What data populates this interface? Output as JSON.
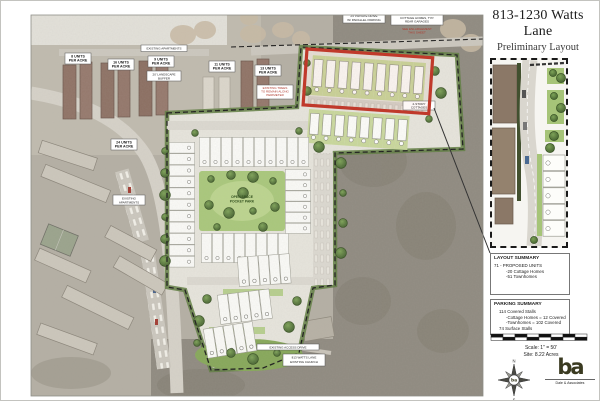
{
  "sheet": {
    "title": "813-1230 Watts Lane",
    "subtitle": "Preliminary Layout"
  },
  "map": {
    "density_labels": [
      {
        "l1": "8 UNITS",
        "l2": "PER ACRE"
      },
      {
        "l1": "16 UNITS",
        "l2": "PER ACRE"
      },
      {
        "l1": "9 UNITS",
        "l2": "PER ACRE"
      },
      {
        "l1": "11 UNITS",
        "l2": "PER ACRE"
      },
      {
        "l1": "13 UNITS",
        "l2": "PER ACRE"
      },
      {
        "l1": "24 UNITS",
        "l2": "PER ACRE"
      }
    ],
    "apartments_strip": "EXISTING APARTMENTS",
    "buffer_note": {
      "l1": "20' LANDSCAPE",
      "l2": "BUFFER"
    },
    "trees_note": {
      "l1": "EXISTING TREES",
      "l2": "TO REMAIN ALONG",
      "l3": "PERIMETER"
    },
    "drive_note": {
      "l1": "24' PRIVATE DRIVE",
      "l2": "W/ PARALLEL PARKING"
    },
    "cottage_note": {
      "l1": "ALLEY LOADED",
      "l2": "COTTAGE HOMES, TYP.",
      "l3": "REAR GARAGES",
      "r1": "SEE ENLARGEMENT",
      "r2": "THIS SHEET"
    },
    "park_label": {
      "l1": "OPEN SPACE",
      "l2": "POCKET PARK"
    },
    "apts_note": {
      "l1": "EXISTING",
      "l2": "APARTMENTS"
    },
    "cottages_note": {
      "l1": "2-STORY",
      "l2": "COTTAGES"
    },
    "access_label": "EXISTING ACCESS DRIVE",
    "church_note": {
      "l1": "813 WATTS LANE",
      "l2": "EXISTING CHURCH"
    }
  },
  "layout_summary": {
    "title": "LAYOUT SUMMARY",
    "line1": "71 - PROPOSED UNITS",
    "line2": "-20 Cottage Homes",
    "line3": "-51 Townhomes"
  },
  "parking_summary": {
    "title": "PARKING SUMMARY",
    "line1": "114 Covered Stalls",
    "line2": "-Cottage Homes = 12 Covered",
    "line3": "-Townhomes = 102 Covered",
    "line4": "74 Surface Stalls"
  },
  "scale_block": {
    "scale": "Scale: 1\" = 50'",
    "site": "Site: 8.22 Acres"
  },
  "compass": {
    "north": "N",
    "south": "S"
  },
  "logo": {
    "monogram": "ba",
    "firm": "Dale & Associates"
  },
  "colors": {
    "highlight_red": "#c0392b",
    "site_green": "#c9d89c",
    "logo_olive": "#3a3a20"
  }
}
